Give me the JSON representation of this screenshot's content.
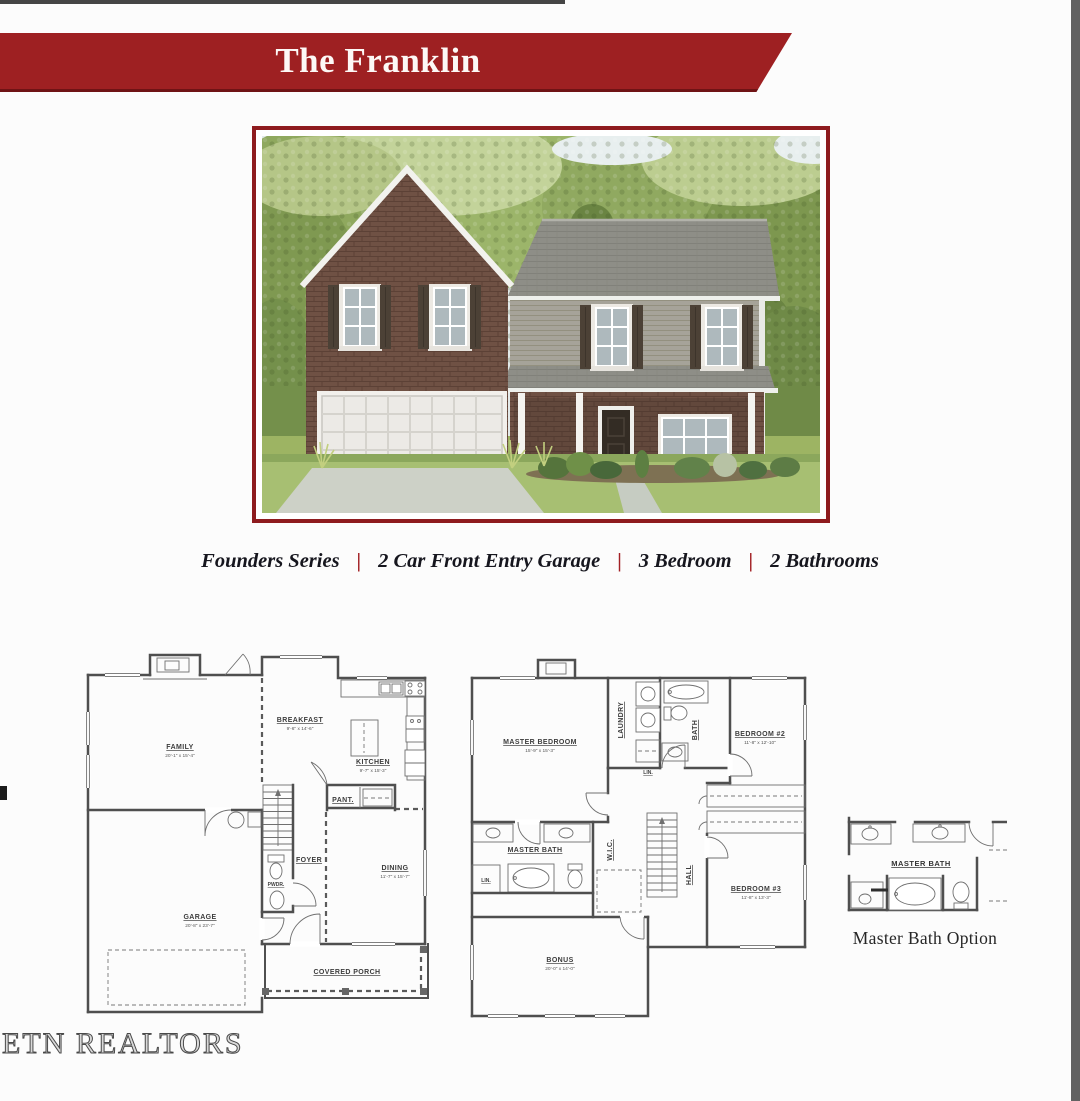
{
  "banner": {
    "title": "The Franklin"
  },
  "photo": {
    "description": "Rendering of two-story home with brick and siding, two-car garage and covered porch"
  },
  "features": {
    "separator": "|",
    "items": [
      "Founders Series",
      "2 Car Front Entry Garage",
      "3 Bedroom",
      "2 Bathrooms"
    ]
  },
  "first_floor": {
    "family": {
      "name": "FAMILY",
      "dims": "20'-1\" x 15'-4\""
    },
    "breakfast": {
      "name": "BREAKFAST",
      "dims": "9'-6\" x 14'-6\""
    },
    "kitchen": {
      "name": "KITCHEN",
      "dims": "9'-7\" x 15'-3\""
    },
    "pantry": {
      "name": "PANT."
    },
    "foyer": {
      "name": "FOYER"
    },
    "powder": {
      "name": "PWDR."
    },
    "dining": {
      "name": "DINING",
      "dims": "11'-7\" x 15'-7\""
    },
    "garage": {
      "name": "GARAGE",
      "dims": "20'-8\" x 23'-7\""
    },
    "porch": {
      "name": "COVERED PORCH"
    }
  },
  "second_floor": {
    "master_bedroom": {
      "name": "MASTER BEDROOM",
      "dims": "15'-9\" x 15'-3\""
    },
    "laundry": {
      "name": "LAUNDRY"
    },
    "bath": {
      "name": "BATH"
    },
    "bedroom2": {
      "name": "BEDROOM #2",
      "dims": "11'-8\" x 12'-10\""
    },
    "linen1": {
      "name": "LIN."
    },
    "master_bath": {
      "name": "MASTER BATH"
    },
    "wic": {
      "name": "W.I.C."
    },
    "linen2": {
      "name": "LIN."
    },
    "hall": {
      "name": "HALL"
    },
    "bedroom3": {
      "name": "BEDROOM #3",
      "dims": "11'-8\" x 13'-3\""
    },
    "bonus": {
      "name": "BONUS",
      "dims": "20'-0\" x 14'-0\""
    }
  },
  "master_bath_option": {
    "room_label": "MASTER BATH",
    "caption": "Master Bath Option"
  },
  "watermark": "ETN REALTORS",
  "colors": {
    "banner_red": "#9e2022",
    "photo_border": "#8e1b1e",
    "separator_red": "#a32125",
    "feature_text": "#16161e",
    "plan_line": "#4f4f4f"
  }
}
